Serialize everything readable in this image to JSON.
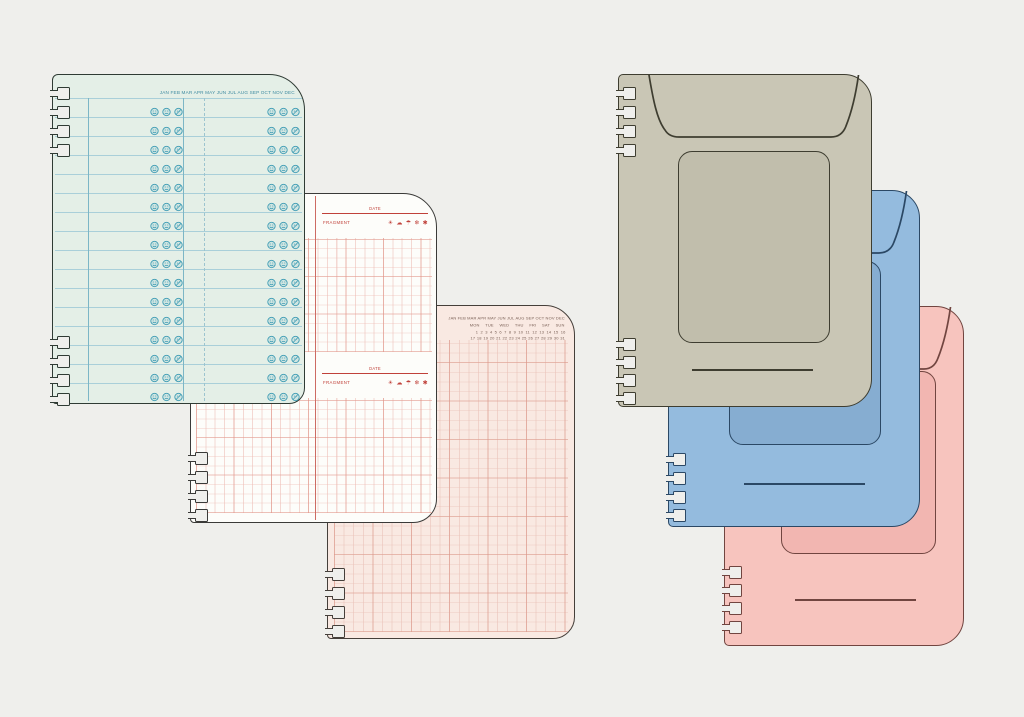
{
  "scene": {
    "background_color": "#efefec",
    "description": "Flat illustration of spiral-punched planner refill pages and three envelope covers"
  },
  "pages": {
    "monthly_log_page": {
      "months_header": "JAN FEB MAR APR MAY JUN JUL AUG SEP OCT NOV DEC",
      "row_count": 16,
      "mood_icons": [
        "happy-face",
        "neutral-face",
        "crossed-face"
      ],
      "colors": {
        "paper": "#e4efe7",
        "rule": "#a9cfd9",
        "accent_rule": "#74b2c2",
        "ink": "#3e8aa0",
        "outline": "#2f3b34"
      }
    },
    "fragment_page": {
      "date_label": "DATE",
      "fragment_label": "FRAGMENT",
      "weather_icons": "☀ ☁ ☂ ❄ ✱",
      "weather_icon_names": [
        "sun",
        "cloud",
        "umbrella",
        "snowflake",
        "asterisk"
      ],
      "section_count": 4,
      "colors": {
        "paper": "#fdfdfa",
        "grid": "#f2cdc7",
        "grid_accent": "#e09286",
        "ink": "#c0413a",
        "divider": "#cd6b63",
        "outline": "#3a3a38"
      }
    },
    "calendar_grid_page": {
      "months_header": "JAN FEB MAR APR MAY JUN JUL AUG SEP OCT NOV DEC",
      "weekdays_header": "MON TUE WED THU FRI SAT SUN",
      "dates_row_1": "1 2 3 4 5 6 7 8 9 10 11 12 13 14 15 16",
      "dates_row_2": "17 18 19 20 21 22 23 24 25 26 27 28 29 30 31",
      "colors": {
        "paper": "#f9e9e2",
        "grid": "#eac3b9",
        "grid_accent": "#db9688",
        "ink": "#7b6157",
        "outline": "#453f3a"
      }
    }
  },
  "covers": {
    "beige_cover": {
      "colors": {
        "cover": "#c9c6b5",
        "window": "#c1beac",
        "outline": "#3e3d30"
      }
    },
    "blue_cover": {
      "colors": {
        "cover": "#94bbde",
        "window": "#86add1",
        "outline": "#2b4865"
      }
    },
    "pink_cover": {
      "colors": {
        "cover": "#f7c4be",
        "window": "#f2b6b1",
        "outline": "#714540"
      }
    }
  }
}
